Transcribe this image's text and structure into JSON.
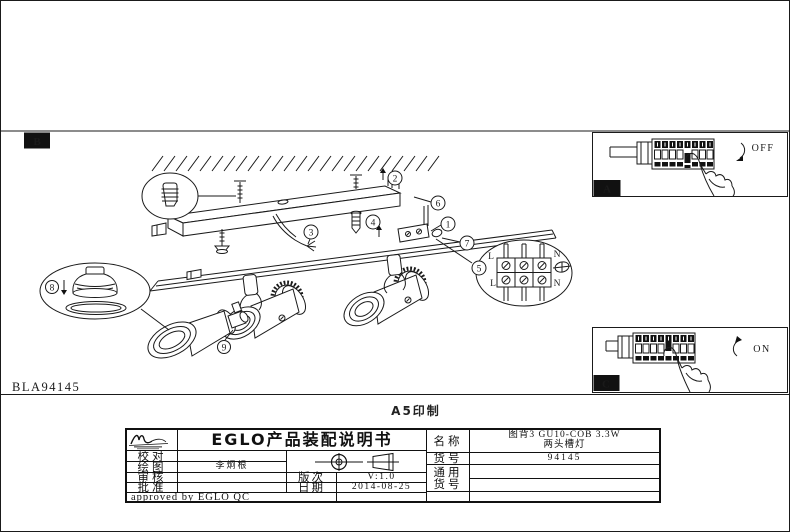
{
  "page": {
    "step_label": "B",
    "drawing_code": "BLA94145",
    "print_label": "A5印制"
  },
  "drawing": {
    "callouts": {
      "c1": "1",
      "c2": "2",
      "c3": "3",
      "c4": "4",
      "c5": "5",
      "c6": "6",
      "c7": "7",
      "c8": "8",
      "c9": "9"
    },
    "terminal": {
      "tl": "L",
      "tr": "N",
      "bl": "L",
      "br": "N"
    },
    "panels": {
      "off": {
        "label": "A",
        "state": "OFF"
      },
      "on": {
        "label": "C",
        "state": "ON"
      }
    }
  },
  "title_block": {
    "title": "EGLO产品装配说明书",
    "check_label": "校对",
    "check_value": "",
    "draw_label": "绘图",
    "draw_value": "李炯根",
    "review_label": "审核",
    "review_value": "",
    "approve_label": "批准",
    "approve_value": "",
    "version_label": "版次",
    "version_value": "V:1.0",
    "date_label": "日期",
    "date_value": "2014-08-25",
    "name_label": "名称",
    "name_line1": "图背3 GU10-COB 3.3W",
    "name_line2": "两头槽灯",
    "item_label": "货号",
    "item_value": "94145",
    "general_line1": "通用",
    "general_line2": "货号",
    "approved": "approved by EGLO QC"
  }
}
